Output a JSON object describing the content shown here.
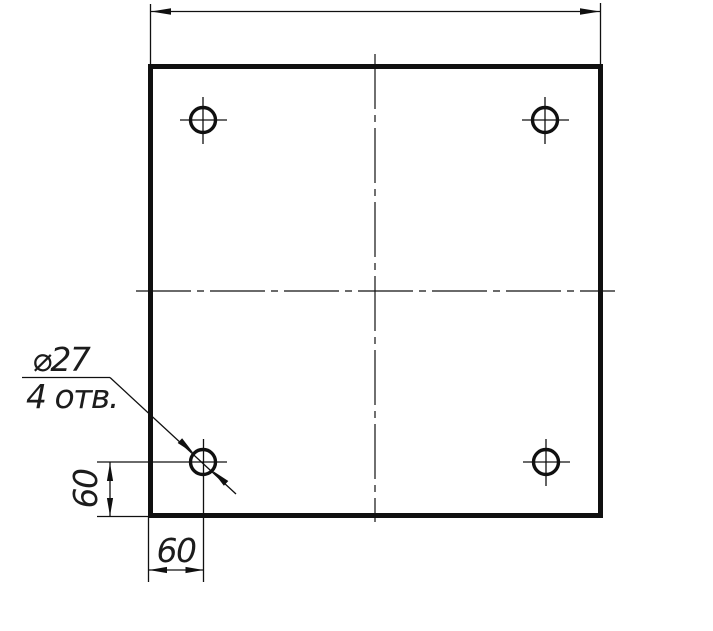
{
  "drawing": {
    "type": "technical-drawing",
    "background_color": "#ffffff",
    "ink_color": "#101010",
    "leader_note": {
      "line1": "⌀27",
      "line2": "4 отв."
    },
    "dimensions": {
      "hole_offset_left": "60",
      "hole_offset_bottom": "60"
    },
    "holes_count": 4
  }
}
